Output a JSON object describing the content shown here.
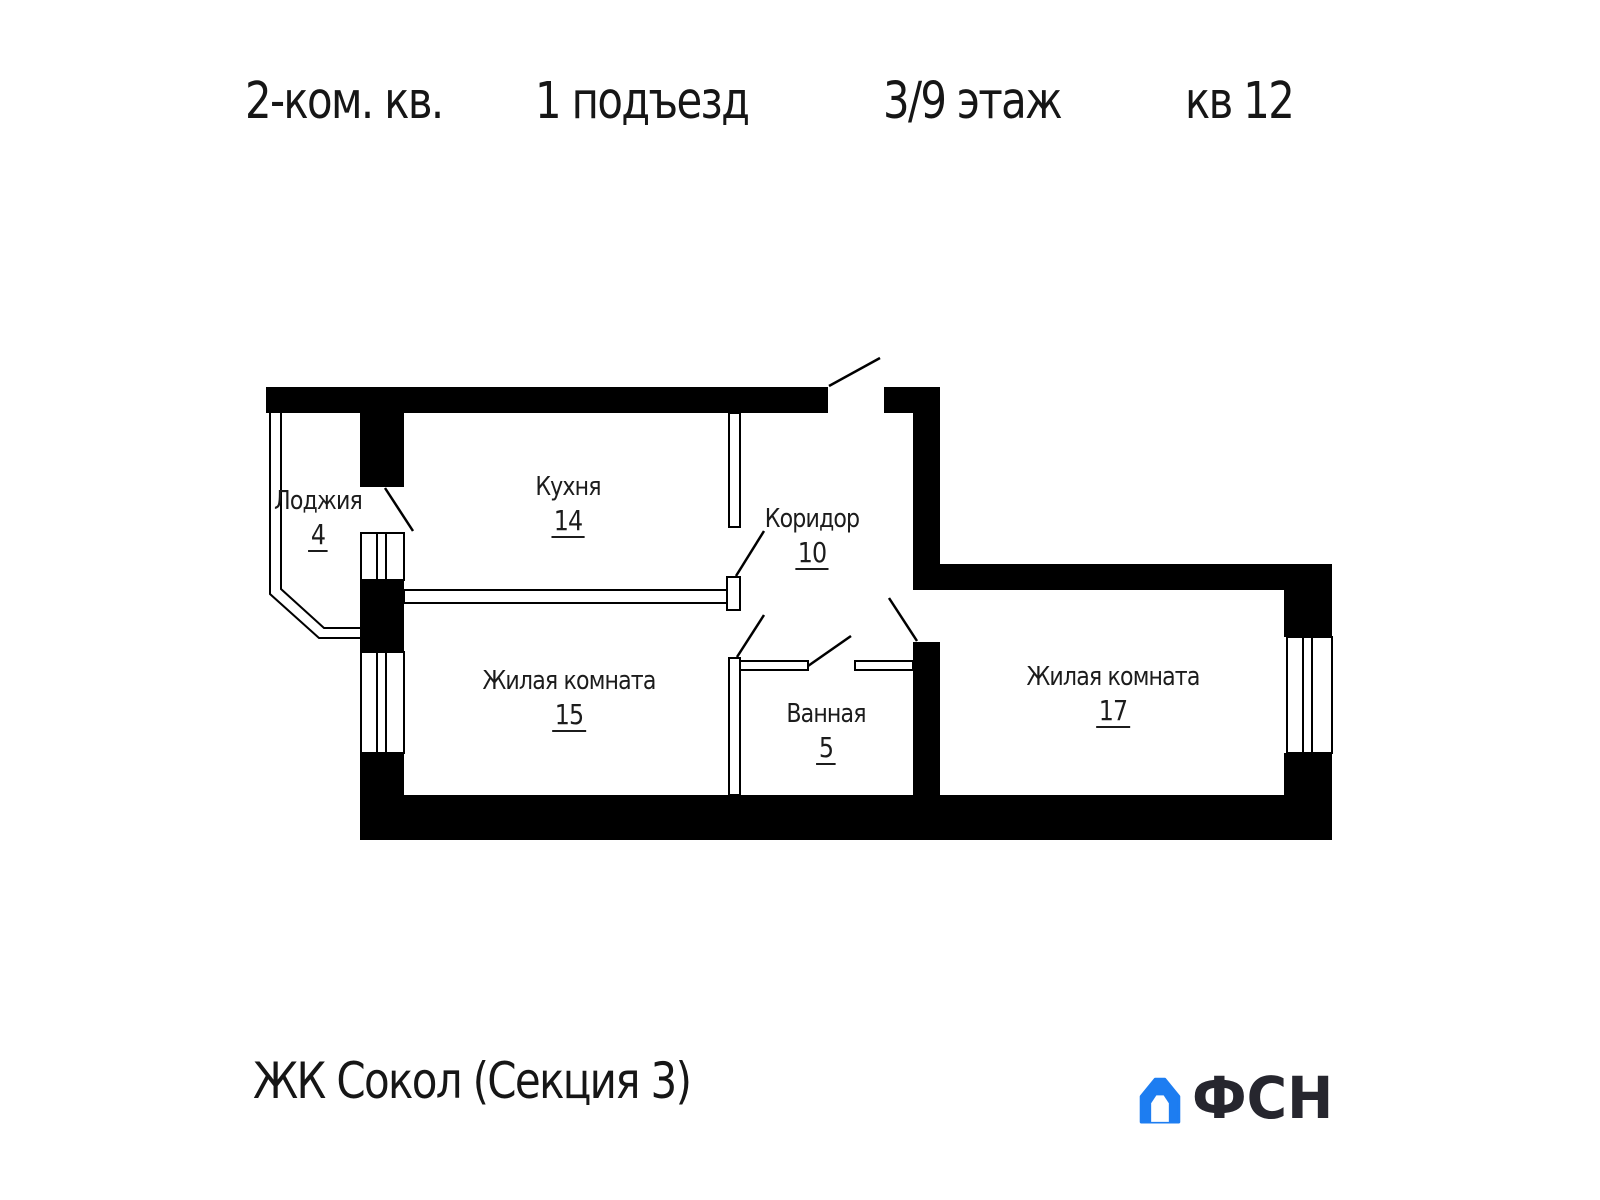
{
  "header": {
    "apartment_type": "2-ком. кв.",
    "entrance": "1 подъезд",
    "floor": "3/9 этаж",
    "apartment_number": "кв 12"
  },
  "rooms": [
    {
      "name": "Лоджия",
      "area": "4"
    },
    {
      "name": "Кухня",
      "area": "14"
    },
    {
      "name": "Коридор",
      "area": "10"
    },
    {
      "name": "Жилая комната",
      "area": "15"
    },
    {
      "name": "Ванная",
      "area": "5"
    },
    {
      "name": "Жилая комната",
      "area": "17"
    }
  ],
  "footer": {
    "complex_name": "ЖК Сокол (Секция 3)",
    "logo_text": "ФСН",
    "logo_color": "#1d7df1",
    "logo_text_color": "#26262e"
  }
}
